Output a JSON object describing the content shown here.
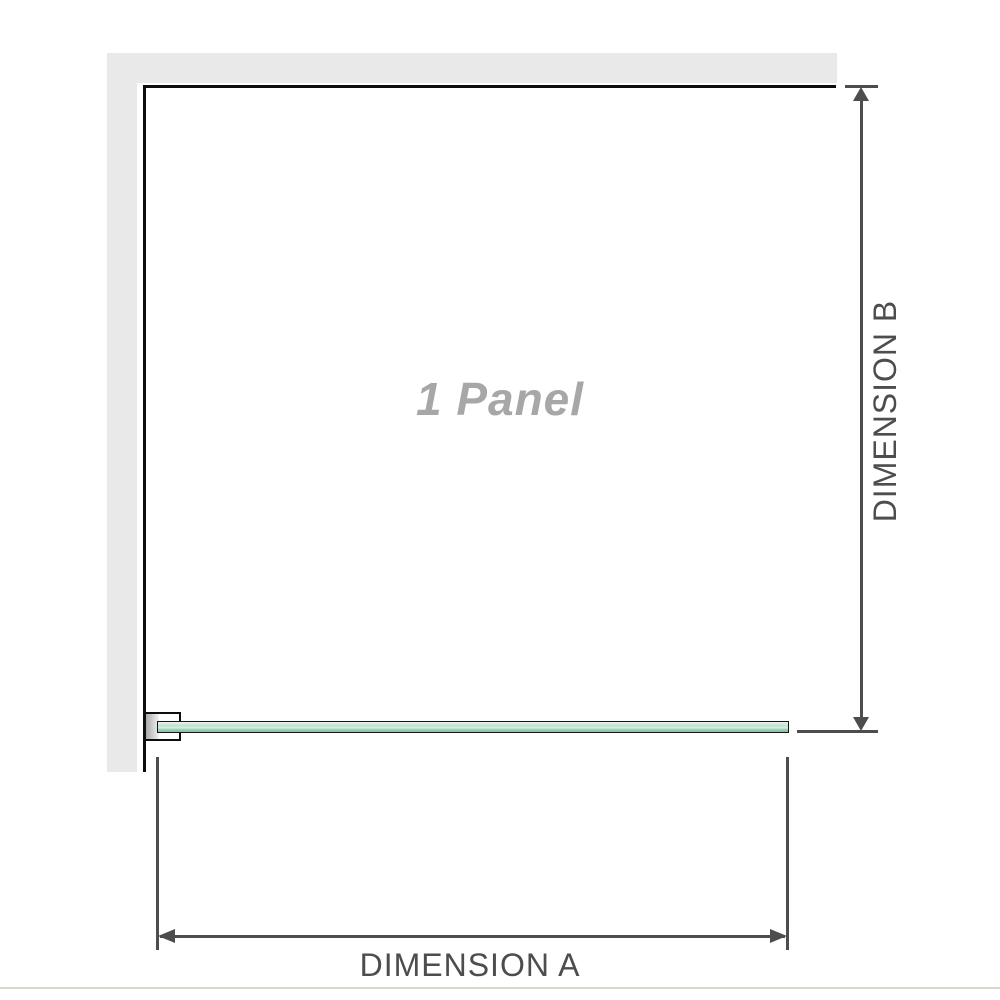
{
  "diagram": {
    "watermark": "1 Panel",
    "dimension_a": {
      "label": "DIMENSION A"
    },
    "dimension_b": {
      "label": "DIMENSION B"
    },
    "colors": {
      "background": "#ffffff",
      "wall": "#e9e9e9",
      "edge": "#0d0d0d",
      "dim": "#4d4d4d",
      "watermark": "#a7a7a7",
      "glass-border": "#161616",
      "glass-top": "#e9f5ee",
      "glass-mid": "#bce2cc",
      "glass-shine": "#d9efe2",
      "glass-deep": "#8cc6a5",
      "divider": "#dcd8d0"
    }
  }
}
